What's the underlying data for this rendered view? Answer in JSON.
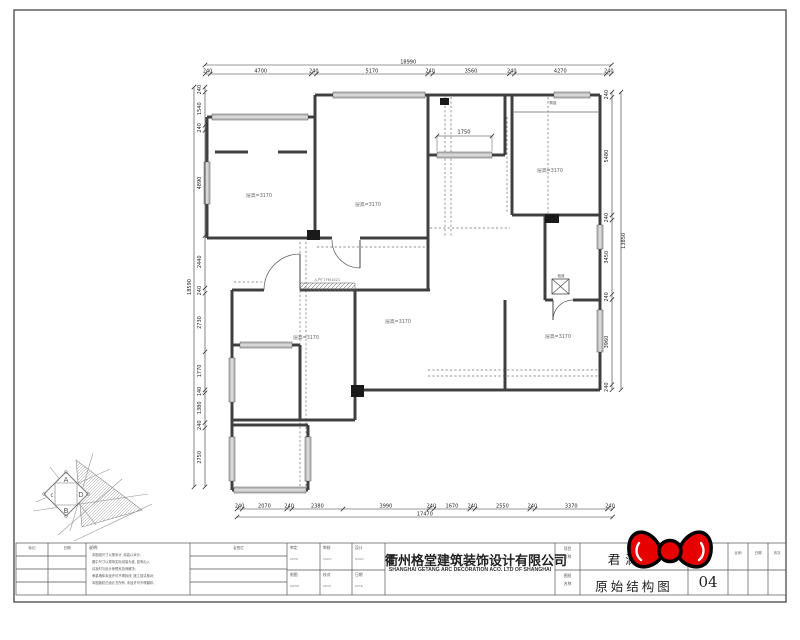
{
  "plan": {
    "rooms": [
      {
        "label": "层高=3170"
      },
      {
        "label": "层高=3170"
      },
      {
        "label": "层高=3170"
      },
      {
        "label": "层高=3170"
      },
      {
        "label": "层高=3170"
      },
      {
        "label": "层高=3170"
      }
    ],
    "annotations": {
      "interior_dim": "1750",
      "bay_tag": "飘窗",
      "entry_note": "入户门 FM1021",
      "flue": "烟道"
    },
    "dimensions": {
      "top": {
        "segments": [
          240,
          4700,
          240,
          5170,
          240,
          3560,
          240,
          4270,
          240
        ],
        "total": "18990"
      },
      "bottom": {
        "segments": [
          240,
          2070,
          240,
          2380,
          3990,
          240,
          1670,
          240,
          2550,
          240,
          3370,
          240
        ],
        "total": "17470"
      },
      "left": {
        "segments": [
          240,
          1540,
          240,
          4890,
          2440,
          240,
          2730,
          1770,
          140,
          1380,
          240,
          2750
        ],
        "total": "18590"
      },
      "right": {
        "segments": [
          240,
          5480,
          240,
          3450,
          240,
          3960,
          240
        ],
        "total": "13850"
      }
    }
  },
  "title_block": {
    "notes": {
      "col1_header": "标记",
      "col2_header": "日期",
      "sign_header": "会签栏",
      "title": "说明:",
      "lines": [
        "本图纸尺寸以毫米计, 标高以米计;",
        "图中尺寸以现场实际测量为准, 如有出入",
        "请及时与设计师联系协商解决;",
        "承重墙体未经许可不得拆改, 施工前请核对;",
        "本图版权归设计方所有, 未经许可不得翻印。"
      ]
    },
    "staff": [
      {
        "label": "审定",
        "en": "APPD"
      },
      {
        "label": "审核",
        "en": "CHKD"
      },
      {
        "label": "设计",
        "en": "DSGN"
      },
      {
        "label": "制图",
        "en": "DRWN"
      },
      {
        "label": "校对",
        "en": "PROF"
      },
      {
        "label": "日期",
        "en": "DATE"
      }
    ],
    "company": {
      "cn": "衢州格堂建筑装饰设计有限公司",
      "en": "SHANGHAI GETANG ARC DECORATION ACO. LTD OF SHANGHAI"
    },
    "project": {
      "label_1": "项目",
      "label_2": "名称",
      "value": "君澜湾"
    },
    "drawing": {
      "label_1": "图纸",
      "label_2": "名称",
      "value": "原始结构图"
    },
    "sheet_no": {
      "label": "图号",
      "value": "04"
    },
    "extra_cols": [
      {
        "label": "比例"
      },
      {
        "label": "日期"
      },
      {
        "label": "页次"
      }
    ]
  },
  "logo": {
    "letter_top": "A",
    "letter_right": "D",
    "letter_bottom": "B",
    "letter_left": "c"
  },
  "colors": {
    "wall": "#3f3f3f",
    "dim": "#222222",
    "bow_red": "#e60000",
    "window_fill": "#bfbfbf"
  }
}
